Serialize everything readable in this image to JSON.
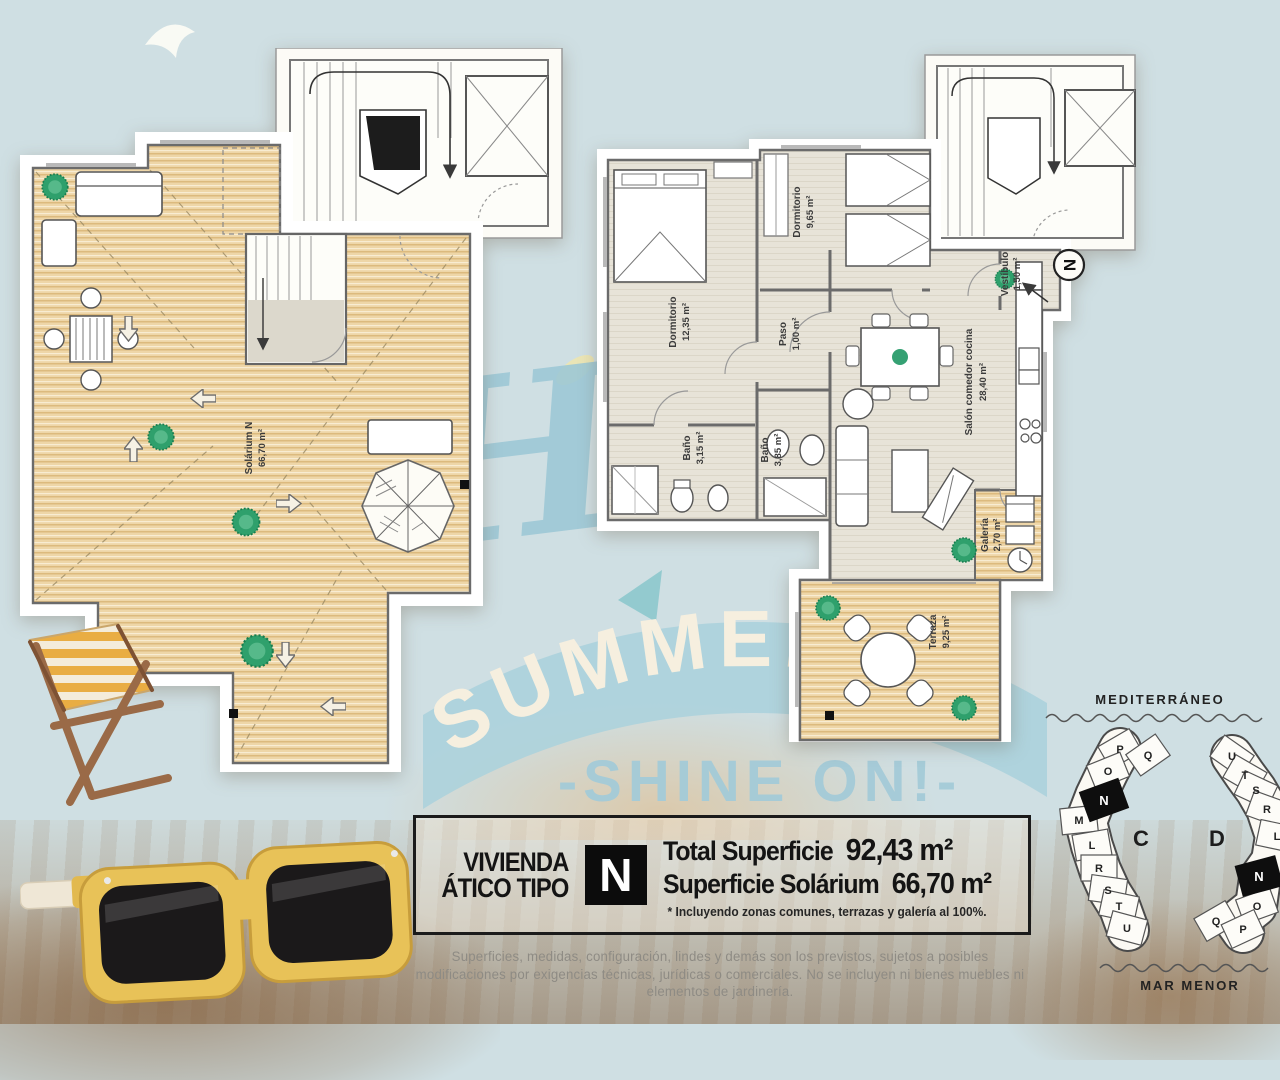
{
  "watermark": {
    "hello": "Hello",
    "summer": "SUMMER",
    "shine_on": "-SHINE ON!-"
  },
  "left_plan": {
    "room_label": "Solárium N",
    "room_area": "66,70 m²"
  },
  "right_plan": {
    "north_label": "N",
    "rooms": [
      {
        "name": "Dormitorio",
        "area": "12,35 m²"
      },
      {
        "name": "Dormitorio",
        "area": "9,65 m²"
      },
      {
        "name": "Paso",
        "area": "1,00 m²"
      },
      {
        "name": "Baño",
        "area": "3,15 m²"
      },
      {
        "name": "Baño",
        "area": "3,85 m²"
      },
      {
        "name": "Salón comedor cocina",
        "area": "28,40 m²"
      },
      {
        "name": "Vestíbulo",
        "area": "1,50 m²"
      },
      {
        "name": "Galería",
        "area": "2,70 m²"
      },
      {
        "name": "Terraza",
        "area": "9,25 m²"
      }
    ]
  },
  "info_box": {
    "dwelling_line1": "VIVIENDA",
    "dwelling_line2": "ÁTICO TIPO",
    "type_letter": "N",
    "total_label": "Total Superficie",
    "total_value": "92,43 m²",
    "solarium_label": "Superficie Solárium",
    "solarium_value": "66,70 m²",
    "footnote": "* Incluyendo zonas comunes, terrazas y galería al 100%."
  },
  "site_plan": {
    "sea_top": "MEDITERRÁNEO",
    "sea_bottom": "MAR MENOR",
    "building_c_label": "C",
    "building_d_label": "D",
    "building_c_units": [
      "P",
      "Q",
      "O",
      "N",
      "M",
      "L",
      "R",
      "S",
      "T",
      "U"
    ],
    "building_d_units": [
      "U",
      "T",
      "S",
      "R",
      "L",
      "N",
      "O",
      "Q",
      "P"
    ]
  },
  "disclaimer": "Superficies, medidas, configuración, lindes y demás son los previstos, sujetos a posibles modificaciones por exigencias técnicas, jurídicas o comerciales. No se incluyen ni bienes muebles ni elementos de jardinería.",
  "colors": {
    "watermark_blue": "#a4cbd8",
    "deck_wood": "#eed6a8",
    "interior_floor": "#e7e3d8",
    "badge_black": "#0c0c0c",
    "plant_green": "#35a173",
    "frame_yellow": "#e8c258"
  }
}
